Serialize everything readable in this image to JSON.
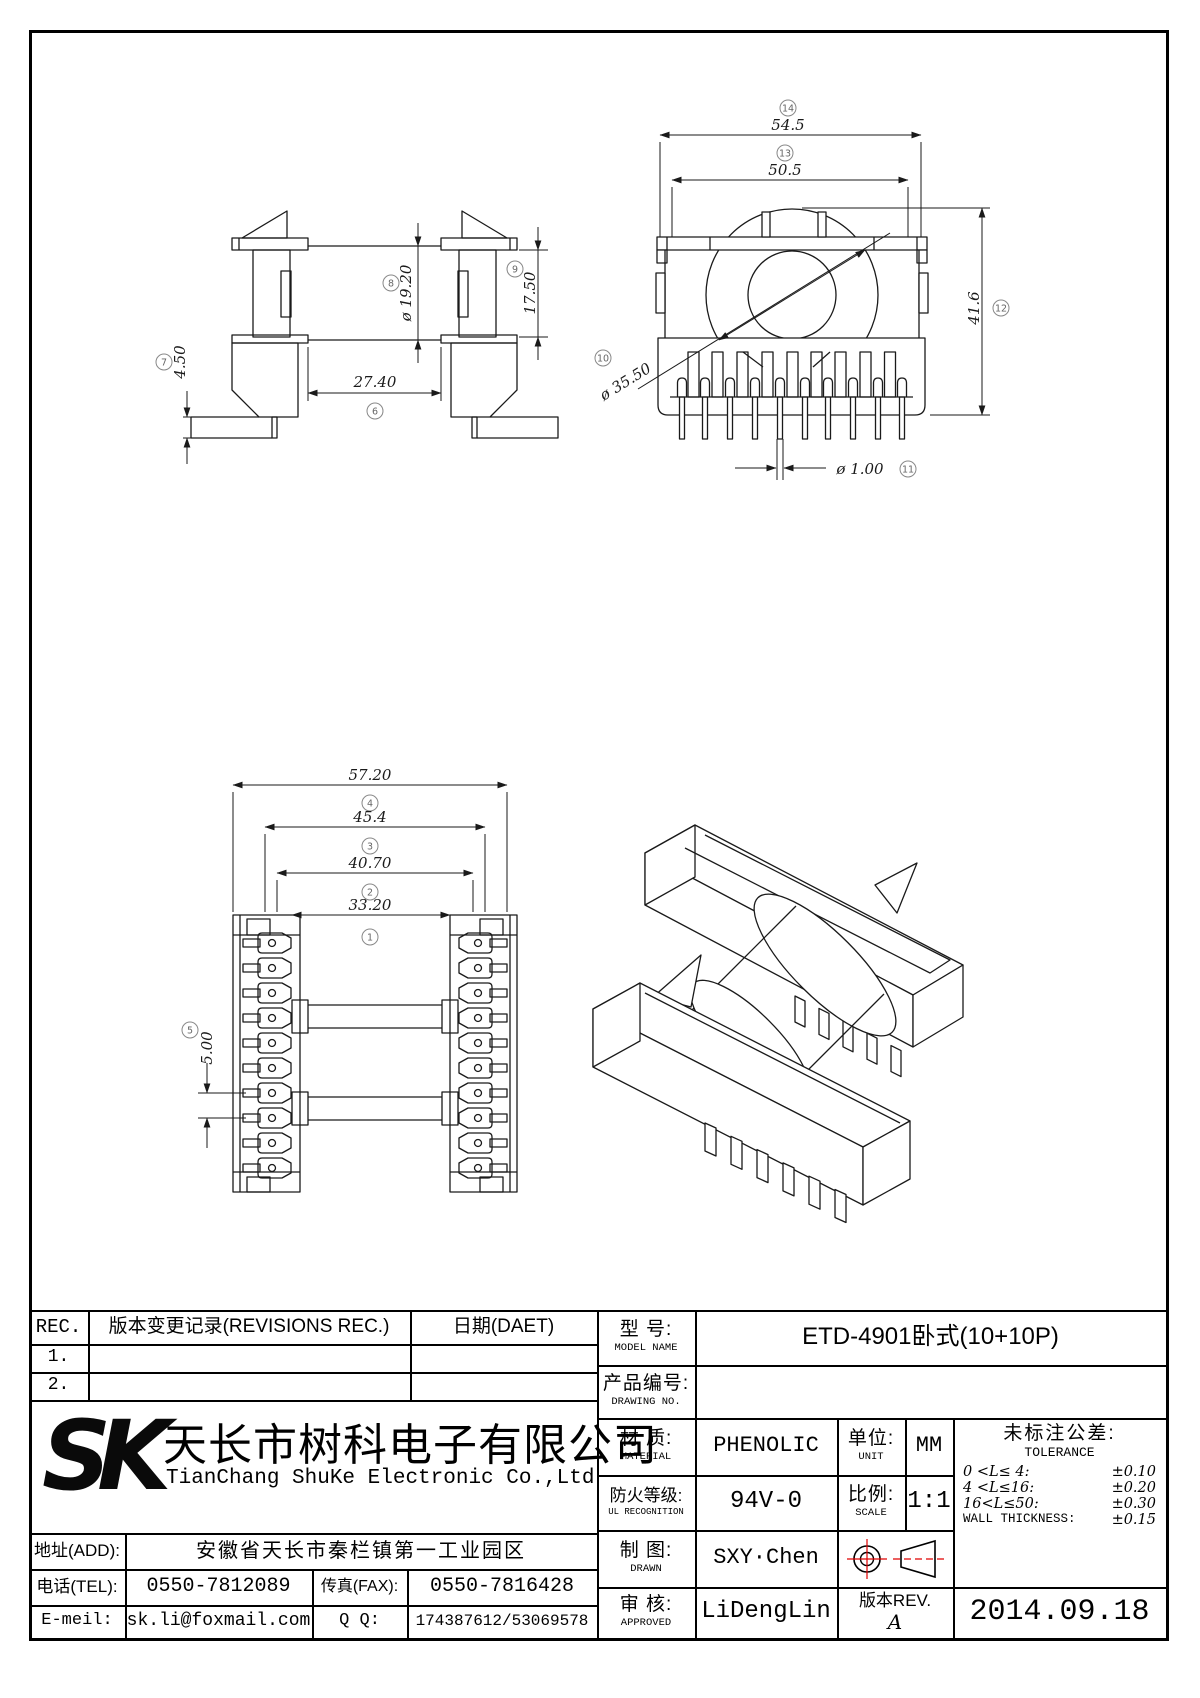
{
  "sheet": {
    "bg": "#ffffff",
    "line_color": "#1a1a1a",
    "accent_red": "#e00000"
  },
  "views": {
    "side": {
      "dims": {
        "d6": {
          "num": "6",
          "label": "27.40"
        },
        "d7": {
          "num": "7",
          "label": "4.50"
        },
        "d8": {
          "num": "8",
          "label": "ø 19.20"
        },
        "d9": {
          "num": "9",
          "label": "17.50"
        }
      }
    },
    "front": {
      "dims": {
        "d10": {
          "num": "10",
          "label": "ø 35.50"
        },
        "d11": {
          "num": "11",
          "label": "ø 1.00"
        },
        "d12": {
          "num": "12",
          "label": "41.6"
        },
        "d13": {
          "num": "13",
          "label": "50.5"
        },
        "d14": {
          "num": "14",
          "label": "54.5"
        }
      }
    },
    "top": {
      "dims": {
        "d1": {
          "num": "1",
          "label": "33.20"
        },
        "d2": {
          "num": "2",
          "label": "40.70"
        },
        "d3": {
          "num": "3",
          "label": "45.4"
        },
        "d4": {
          "num": "4",
          "label": "57.20"
        },
        "d5": {
          "num": "5",
          "label": "5.00"
        }
      }
    }
  },
  "revision_table": {
    "col_rec": "REC.",
    "col_desc": "版本变更记录(REVISIONS REC.)",
    "col_date": "日期(DAET)",
    "rows": [
      {
        "no": "1."
      },
      {
        "no": "2."
      }
    ]
  },
  "company": {
    "logo": "SK",
    "name_cn": "天长市树科电子有限公司",
    "name_en": "TianChang ShuKe Electronic Co.,Ltd",
    "addr_label": "地址(ADD):",
    "addr": "安徽省天长市秦栏镇第一工业园区",
    "tel_label": "电话(TEL):",
    "tel": "0550-7812089",
    "fax_label": "传真(FAX):",
    "fax": "0550-7816428",
    "email_label": "E-meil:",
    "email": "sk.li@foxmail.com",
    "qq_label": "Q Q:",
    "qq": "174387612/53069578"
  },
  "title_block": {
    "model_label_cn": "型  号:",
    "model_label_en": "MODEL NAME",
    "model": "ETD-4901卧式(10+10P)",
    "drawing_label_cn": "产品编号:",
    "drawing_label_en": "DRAWING NO.",
    "drawing_no": "",
    "material_label_cn": "材  质:",
    "material_label_en": "MATERIAL",
    "material": "PHENOLIC",
    "unit_label_cn": "单位:",
    "unit_label_en": "UNIT",
    "unit": "MM",
    "fire_label_cn": "防火等级:",
    "fire_label_en": "UL RECOGNITION",
    "fire": "94V-0",
    "scale_label_cn": "比例:",
    "scale_label_en": "SCALE",
    "scale": "1:1",
    "drawn_label_cn": "制  图:",
    "drawn_label_en": "DRAWN",
    "drawn": "SXY·Chen",
    "approved_label_cn": "审  核:",
    "approved_label_en": "APPROVED",
    "approved": "LiDengLin",
    "rev_label": "版本REV.",
    "rev": "A",
    "date": "2014.09.18",
    "tol_title_cn": "未标注公差:",
    "tol_title_en": "TOLERANCE",
    "tolerances": [
      {
        "range": "0 <L≤ 4:",
        "value": "±0.10"
      },
      {
        "range": "4 <L≤16:",
        "value": "±0.20"
      },
      {
        "range": "16<L≤50:",
        "value": "±0.30"
      },
      {
        "range": "WALL THICKNESS:",
        "value": "±0.15"
      }
    ]
  }
}
